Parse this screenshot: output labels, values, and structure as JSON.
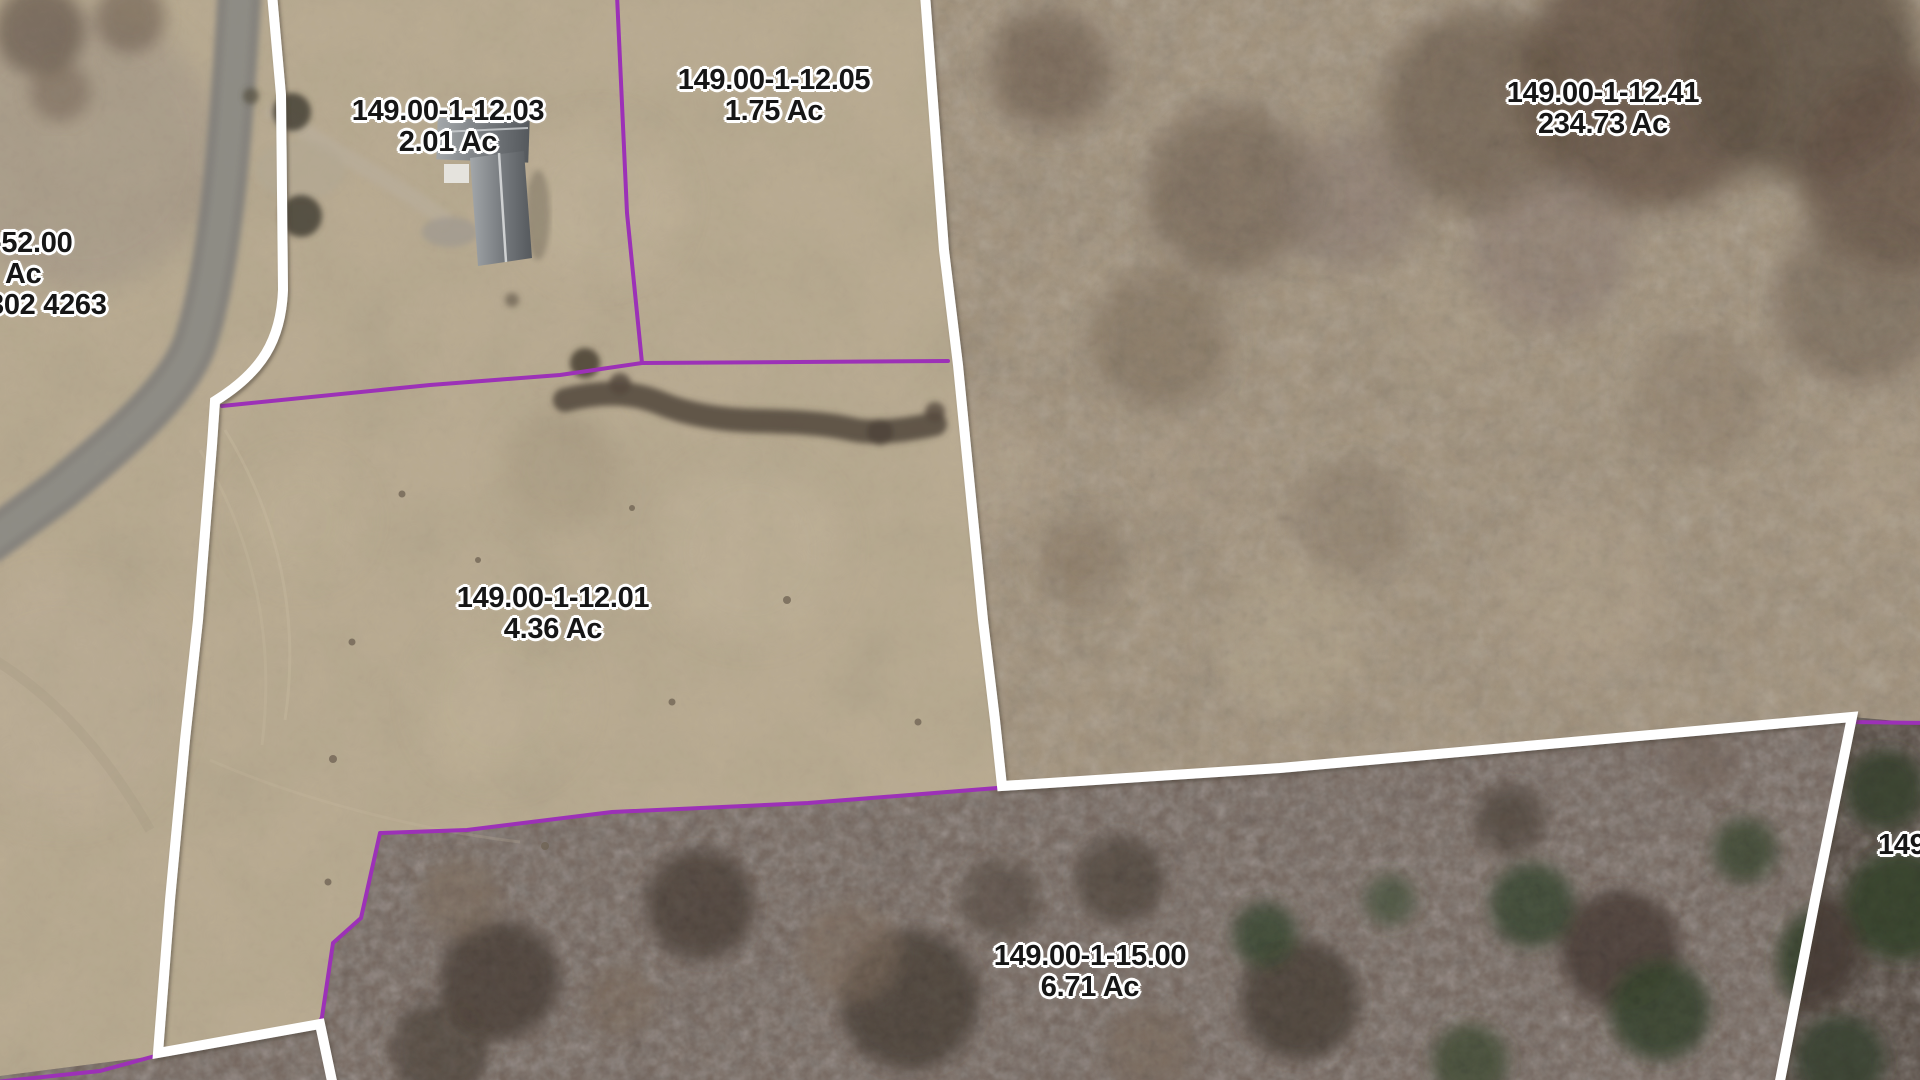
{
  "map": {
    "parcels": [
      {
        "id": "149.00-1-12.03",
        "acreage": "2.01 Ac"
      },
      {
        "id": "149.00-1-12.05",
        "acreage": "1.75 Ac"
      },
      {
        "id": "149.00-1-12.41",
        "acreage": "234.73 Ac"
      },
      {
        "id": "149.00-1-12.01",
        "acreage": "4.36 Ac"
      },
      {
        "id": "149.00-1-15.00",
        "acreage": "6.71 Ac"
      }
    ],
    "partial_labels": {
      "left": {
        "line1": "-52.00",
        "line2": "Ac",
        "line3": "302 4263"
      },
      "right": {
        "line1": "149"
      }
    },
    "colors": {
      "boundary_primary": "#ffffff",
      "boundary_secondary": "#9c31b7",
      "label_text": "#161616",
      "label_halo": "#ffffff",
      "field_tan": "#bcae94",
      "brush_brown": "#a29179",
      "forest_brown": "#6f5f55",
      "conifer_green": "#44523a",
      "road_gray": "#7e7d79"
    }
  }
}
